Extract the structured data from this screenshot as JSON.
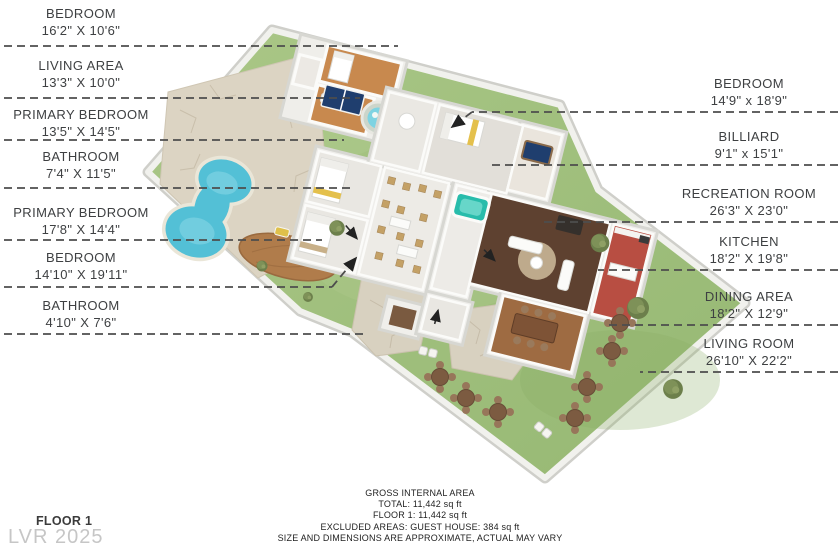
{
  "left_labels": [
    {
      "name": "BEDROOM",
      "dims": "16'2\" X 10'6\""
    },
    {
      "name": "LIVING AREA",
      "dims": "13'3\" X 10'0\""
    },
    {
      "name": "PRIMARY BEDROOM",
      "dims": "13'5\" X 14'5\""
    },
    {
      "name": "BATHROOM",
      "dims": "7'4\" X 11'5\""
    },
    {
      "name": "PRIMARY BEDROOM",
      "dims": "17'8\" X 14'4\""
    },
    {
      "name": "BEDROOM",
      "dims": "14'10\" X 19'11\""
    },
    {
      "name": "BATHROOM",
      "dims": "4'10\" X 7'6\""
    }
  ],
  "right_labels": [
    {
      "name": "BEDROOM",
      "dims": "14'9\" x 18'9\""
    },
    {
      "name": "BILLIARD",
      "dims": "9'1\" x 15'1\""
    },
    {
      "name": "RECREATION ROOM",
      "dims": "26'3\" X 23'0\""
    },
    {
      "name": "KITCHEN",
      "dims": "18'2\" X 19'8\""
    },
    {
      "name": "DINING AREA",
      "dims": "18'2\" X 12'9\""
    },
    {
      "name": "LIVING ROOM",
      "dims": "26'10\" X 22'2\""
    }
  ],
  "footer": {
    "title": "GROSS INTERNAL AREA",
    "total": "TOTAL: 11,442 sq ft",
    "floor": "FLOOR 1: 11,442 sq ft",
    "excluded": "EXCLUDED AREAS: GUEST HOUSE: 384 sq ft",
    "disclaimer": "SIZE AND DIMENSIONS ARE APPROXIMATE, ACTUAL MAY VARY"
  },
  "corner": {
    "floor_label": "FLOOR 1",
    "watermark": "LVR 2025"
  },
  "colors": {
    "lawn": "#a3c281",
    "pool": "#53c0d6",
    "stone": "#dcd4c3",
    "recreation_floor": "#5e4130",
    "kitchen_floor": "#b84e42",
    "dining_floor": "#9e6b42",
    "guest_floor": "#c8894e",
    "spa_tub": "#28bcab",
    "billiard_table": "#1f3e6e",
    "leader_line": "#4d4d4d",
    "label_text": "#3e4042",
    "watermark": "#c6c6c6"
  }
}
